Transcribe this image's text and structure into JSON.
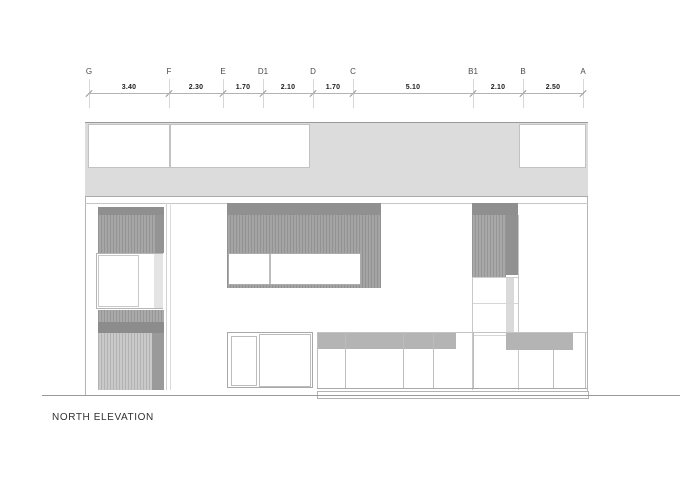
{
  "title": "NORTH ELEVATION",
  "grid": {
    "labels": [
      "G",
      "F",
      "E",
      "D1",
      "D",
      "C",
      "B1",
      "B",
      "A"
    ],
    "dimensions": [
      "3.40",
      "2.30",
      "1.70",
      "2.10",
      "1.70",
      "5.10",
      "2.10",
      "2.50"
    ]
  },
  "colors": {
    "band_light": "#dcdcdc",
    "hatch_medium": "#a6a6a6",
    "hatch_dark": "#8f8f8f",
    "hatch_pale": "#c9c9c9",
    "panel_gray": "#b4b4b4",
    "line_gray": "#b0b0b0",
    "text": "#303030"
  }
}
